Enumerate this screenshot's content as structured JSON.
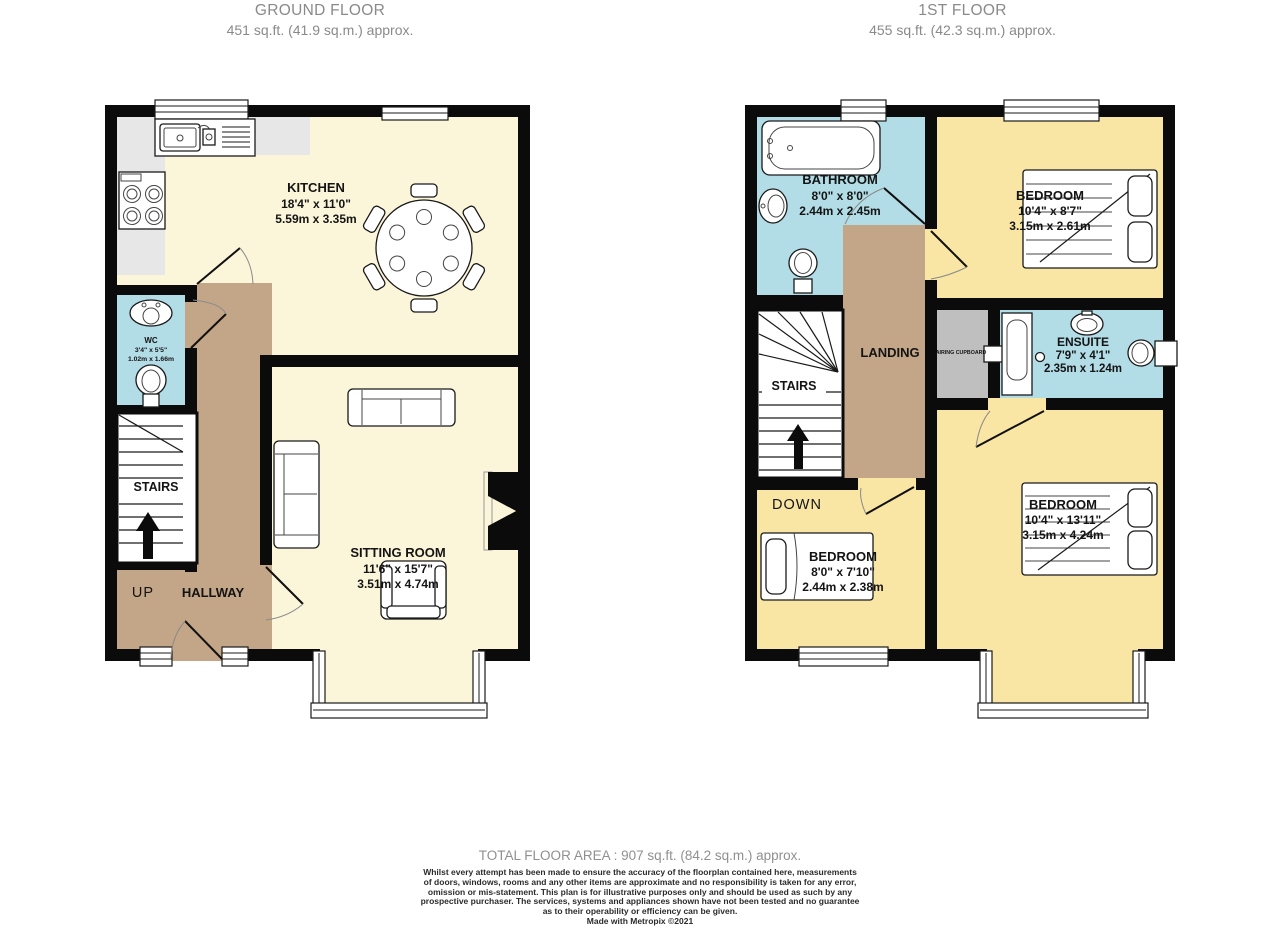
{
  "ground_floor": {
    "title": "GROUND FLOOR",
    "area": "451 sq.ft. (41.9 sq.m.) approx.",
    "rooms": {
      "kitchen": {
        "name": "KITCHEN",
        "imperial": "18'4\"  x  11'0\"",
        "metric": "5.59m  x  3.35m"
      },
      "wc": {
        "name": "WC",
        "imperial": "3'4\"  x  5'5\"",
        "metric": "1.02m  x  1.66m"
      },
      "sitting_room": {
        "name": "SITTING ROOM",
        "imperial": "11'6\"  x  15'7\"",
        "metric": "3.51m  x  4.74m"
      },
      "stairs": {
        "name": "STAIRS"
      },
      "hallway": {
        "name": "HALLWAY"
      },
      "up_label": "UP"
    }
  },
  "first_floor": {
    "title": "1ST FLOOR",
    "area": "455 sq.ft. (42.3 sq.m.) approx.",
    "rooms": {
      "bathroom": {
        "name": "BATHROOM",
        "imperial": "8'0\"  x  8'0\"",
        "metric": "2.44m  x  2.45m"
      },
      "bedroom_1": {
        "name": "BEDROOM",
        "imperial": "10'4\"  x  8'7\"",
        "metric": "3.15m  x  2.61m"
      },
      "ensuite": {
        "name": "ENSUITE",
        "imperial": "7'9\"  x  4'1\"",
        "metric": "2.35m  x  1.24m"
      },
      "bedroom_2": {
        "name": "BEDROOM",
        "imperial": "8'0\"  x  7'10\"",
        "metric": "2.44m  x  2.38m"
      },
      "bedroom_3": {
        "name": "BEDROOM",
        "imperial": "10'4\"  x  13'11\"",
        "metric": "3.15m  x  4.24m"
      },
      "landing": {
        "name": "LANDING"
      },
      "stairs": {
        "name": "STAIRS"
      },
      "airing_cupboard": {
        "name": "AIRING CUPBOARD"
      },
      "down_label": "DOWN"
    }
  },
  "footer": {
    "total_area": "TOTAL FLOOR AREA : 907 sq.ft. (84.2 sq.m.) approx.",
    "disclaimer_lines": [
      "Whilst every attempt has been made to ensure the accuracy of the floorplan contained here, measurements",
      "of doors, windows, rooms and any other items are approximate and no responsibility is taken for any error,",
      "omission or mis-statement. This plan is for illustrative purposes only and should be used as such by any",
      "prospective purchaser. The services, systems and appliances shown have not been tested and no guarantee",
      "as to their operability or efficiency can be given."
    ],
    "credit": "Made with Metropix ©2021"
  },
  "colors": {
    "wall": "#0b0b0b",
    "cream_room": "#FBF5DA",
    "yellow_room": "#F9E5A4",
    "blue_room": "#B2DCE6",
    "hallway_tan": "#C3A587",
    "counter_gray": "#E7E7E7",
    "cupboard_gray": "#BFBFBF",
    "title_gray": "#8a8a8a"
  }
}
